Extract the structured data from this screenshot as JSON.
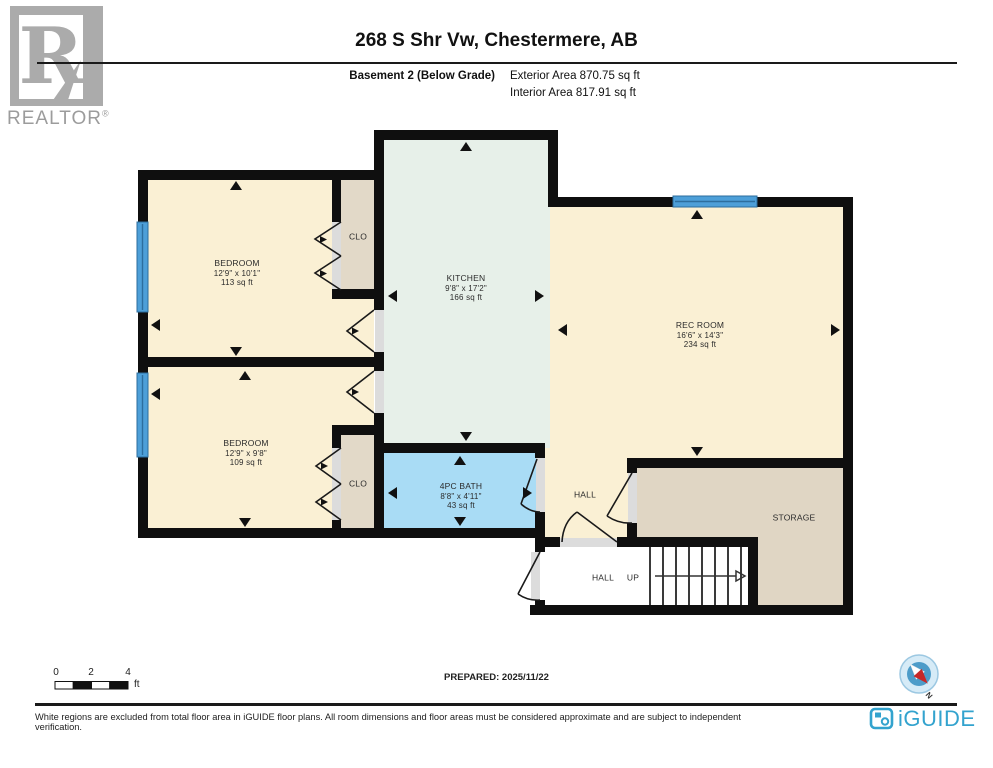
{
  "header": {
    "title": "268 S Shr Vw, Chestermere, AB",
    "floor_label": "Basement 2 (Below Grade)",
    "exterior_area": "Exterior Area 870.75 sq ft",
    "interior_area": "Interior Area 817.91 sq ft"
  },
  "branding": {
    "realtor_letter": "R",
    "realtor_wordmark": "REALTOR",
    "registered_mark": "®",
    "iguide_wordmark": "iGUIDE"
  },
  "rooms": [
    {
      "id": "bedroom-1",
      "name": "BEDROOM",
      "dims": "12'9\" x 10'1\"",
      "area": "113 sq ft"
    },
    {
      "id": "closet-1",
      "name": "CLO"
    },
    {
      "id": "kitchen",
      "name": "KITCHEN",
      "dims": "9'8\" x 17'2\"",
      "area": "166 sq ft"
    },
    {
      "id": "rec-room",
      "name": "REC ROOM",
      "dims": "16'6\" x 14'3\"",
      "area": "234 sq ft"
    },
    {
      "id": "bedroom-2",
      "name": "BEDROOM",
      "dims": "12'9\" x 9'8\"",
      "area": "109 sq ft"
    },
    {
      "id": "closet-2",
      "name": "CLO"
    },
    {
      "id": "bath",
      "name": "4PC BATH",
      "dims": "8'8\" x 4'11\"",
      "area": "43 sq ft"
    },
    {
      "id": "hall",
      "name": "HALL"
    },
    {
      "id": "storage",
      "name": "STORAGE"
    },
    {
      "id": "hall-lower",
      "name": "HALL"
    },
    {
      "id": "stairs",
      "name": "UP"
    }
  ],
  "scale_bar": {
    "labels": [
      "0",
      "2",
      "4"
    ],
    "unit": "ft"
  },
  "prepared": "PREPARED: 2025/11/22",
  "compass": {
    "north_label": "N"
  },
  "footer": {
    "disclaimer": "White regions are excluded from total floor area in iGUIDE floor plans. All room dimensions and floor areas must be considered approximate and are subject to independent verification."
  },
  "colors": {
    "wall": "#0f0f0f",
    "room_cream": "#FAF0D4",
    "kitchen_mint": "#E7F0E9",
    "bath_blue": "#A9DCF5",
    "closet_tan": "#E2D9C8",
    "storage_tan": "#E0D6C4",
    "window_blue": "#4D9FD8",
    "window_blue_dark": "#2C6E9E",
    "threshold_gray": "#DCDCDC",
    "iguide_blue": "#33A3CE",
    "compass_red": "#C62828",
    "logo_gray": "#ABABAB"
  }
}
